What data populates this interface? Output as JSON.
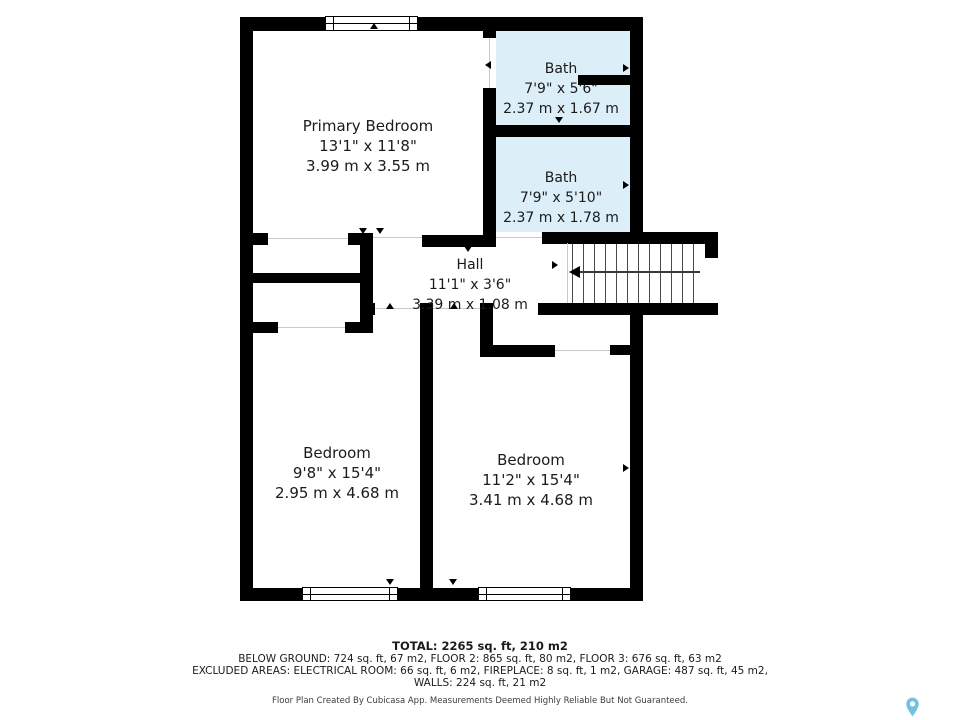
{
  "rooms": [
    {
      "name": "Primary Bedroom",
      "imperial": "13'1\" x 11'8\"",
      "metric": "3.99 m x 3.55 m"
    },
    {
      "name": "Bath",
      "imperial": "7'9\" x 5'6\"",
      "metric": "2.37 m x 1.67 m"
    },
    {
      "name": "Bath",
      "imperial": "7'9\" x 5'10\"",
      "metric": "2.37 m x 1.78 m"
    },
    {
      "name": "Hall",
      "imperial": "11'1\" x 3'6\"",
      "metric": "3.39 m x 1.08 m"
    },
    {
      "name": "Bedroom",
      "imperial": "9'8\" x 15'4\"",
      "metric": "2.95 m x 4.68 m"
    },
    {
      "name": "Bedroom",
      "imperial": "11'2\" x 15'4\"",
      "metric": "3.41 m x 4.68 m"
    }
  ],
  "summary": {
    "total": "TOTAL: 2265 sq. ft, 210 m2",
    "floors": "BELOW GROUND: 724 sq. ft, 67 m2, FLOOR 2: 865 sq. ft, 80 m2, FLOOR 3: 676 sq. ft, 63 m2",
    "excluded": "EXCLUDED AREAS: ELECTRICAL ROOM: 66 sq. ft, 6 m2, FIREPLACE: 8 sq. ft, 1 m2, GARAGE: 487 sq. ft, 45 m2,",
    "walls": "WALLS: 224 sq. ft, 21 m2"
  },
  "disclaimer": "Floor Plan Created By Cubicasa App. Measurements Deemed Highly Reliable But Not Guaranteed.",
  "colors": {
    "wall": "#000000",
    "bath_fill": "#dceef8",
    "pin": "#74c0e0"
  }
}
